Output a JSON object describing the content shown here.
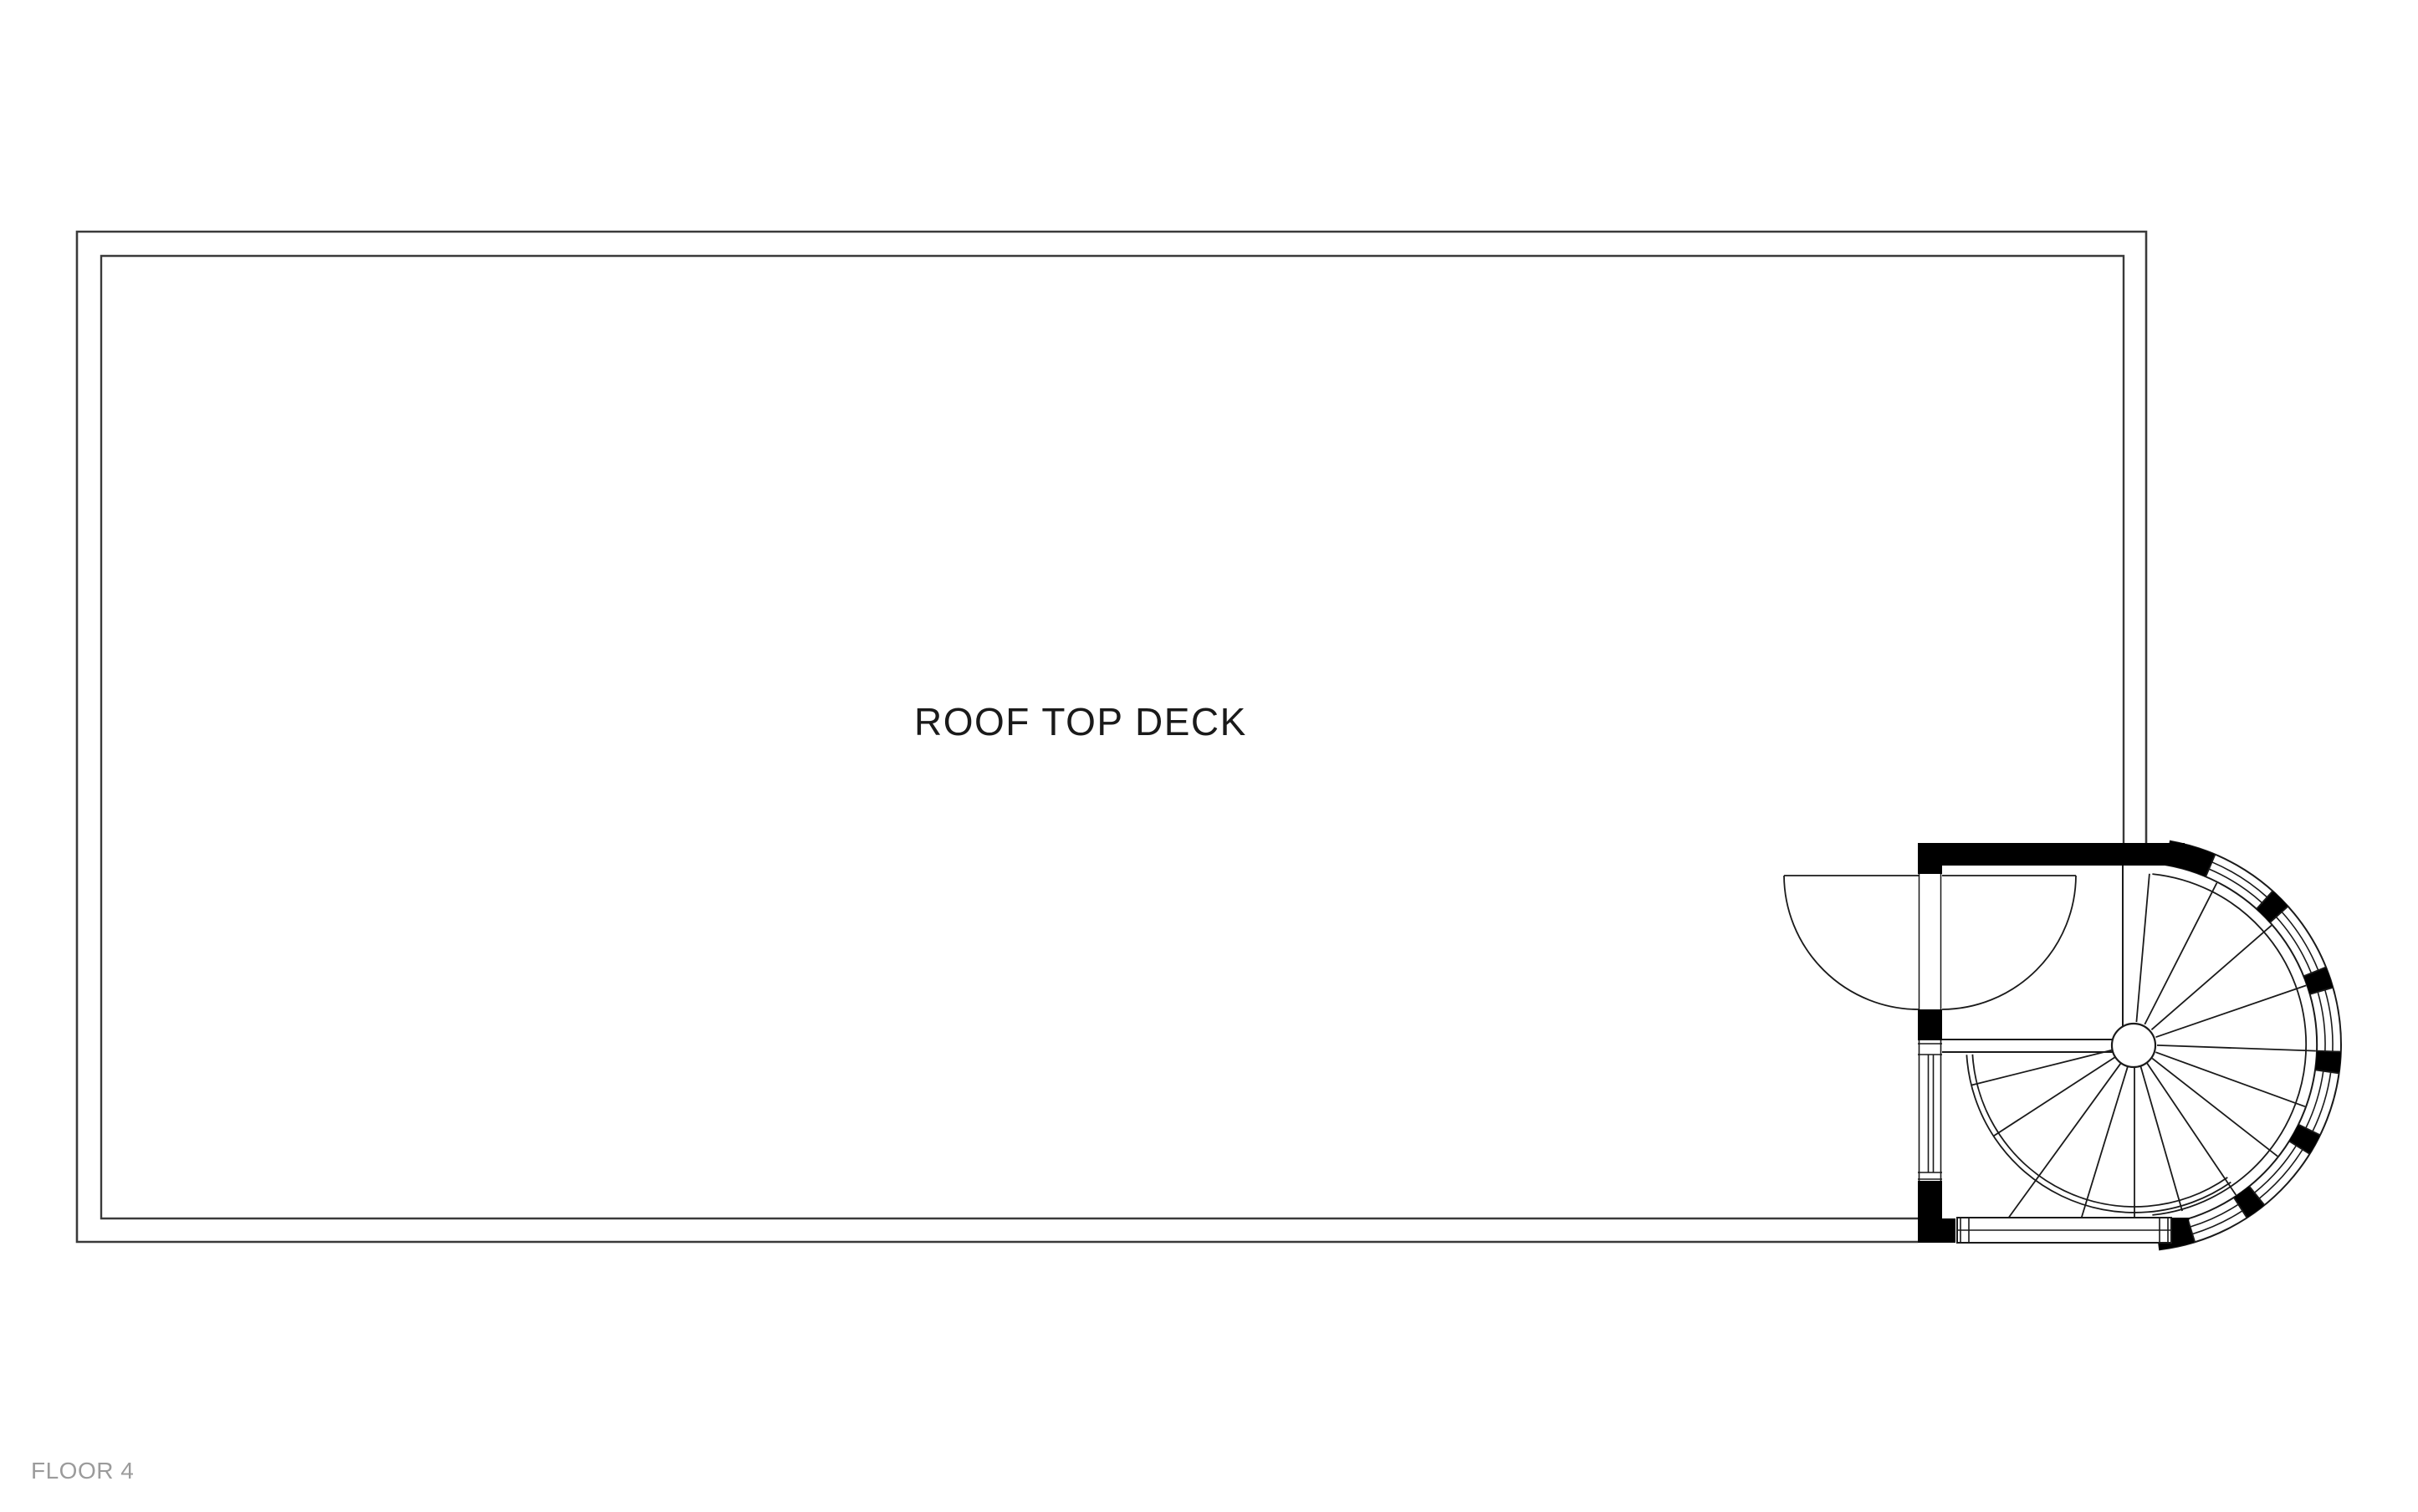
{
  "plan": {
    "room_label": "ROOF TOP DECK",
    "floor_label": "FLOOR 4"
  },
  "colors": {
    "background": "#ffffff",
    "deck_line": "#3a3a3a",
    "stair_line": "#1a1a1a",
    "wall_fill": "#000000",
    "room_label_color": "#1a1a1a",
    "floor_label_color": "#9b9b9b"
  }
}
